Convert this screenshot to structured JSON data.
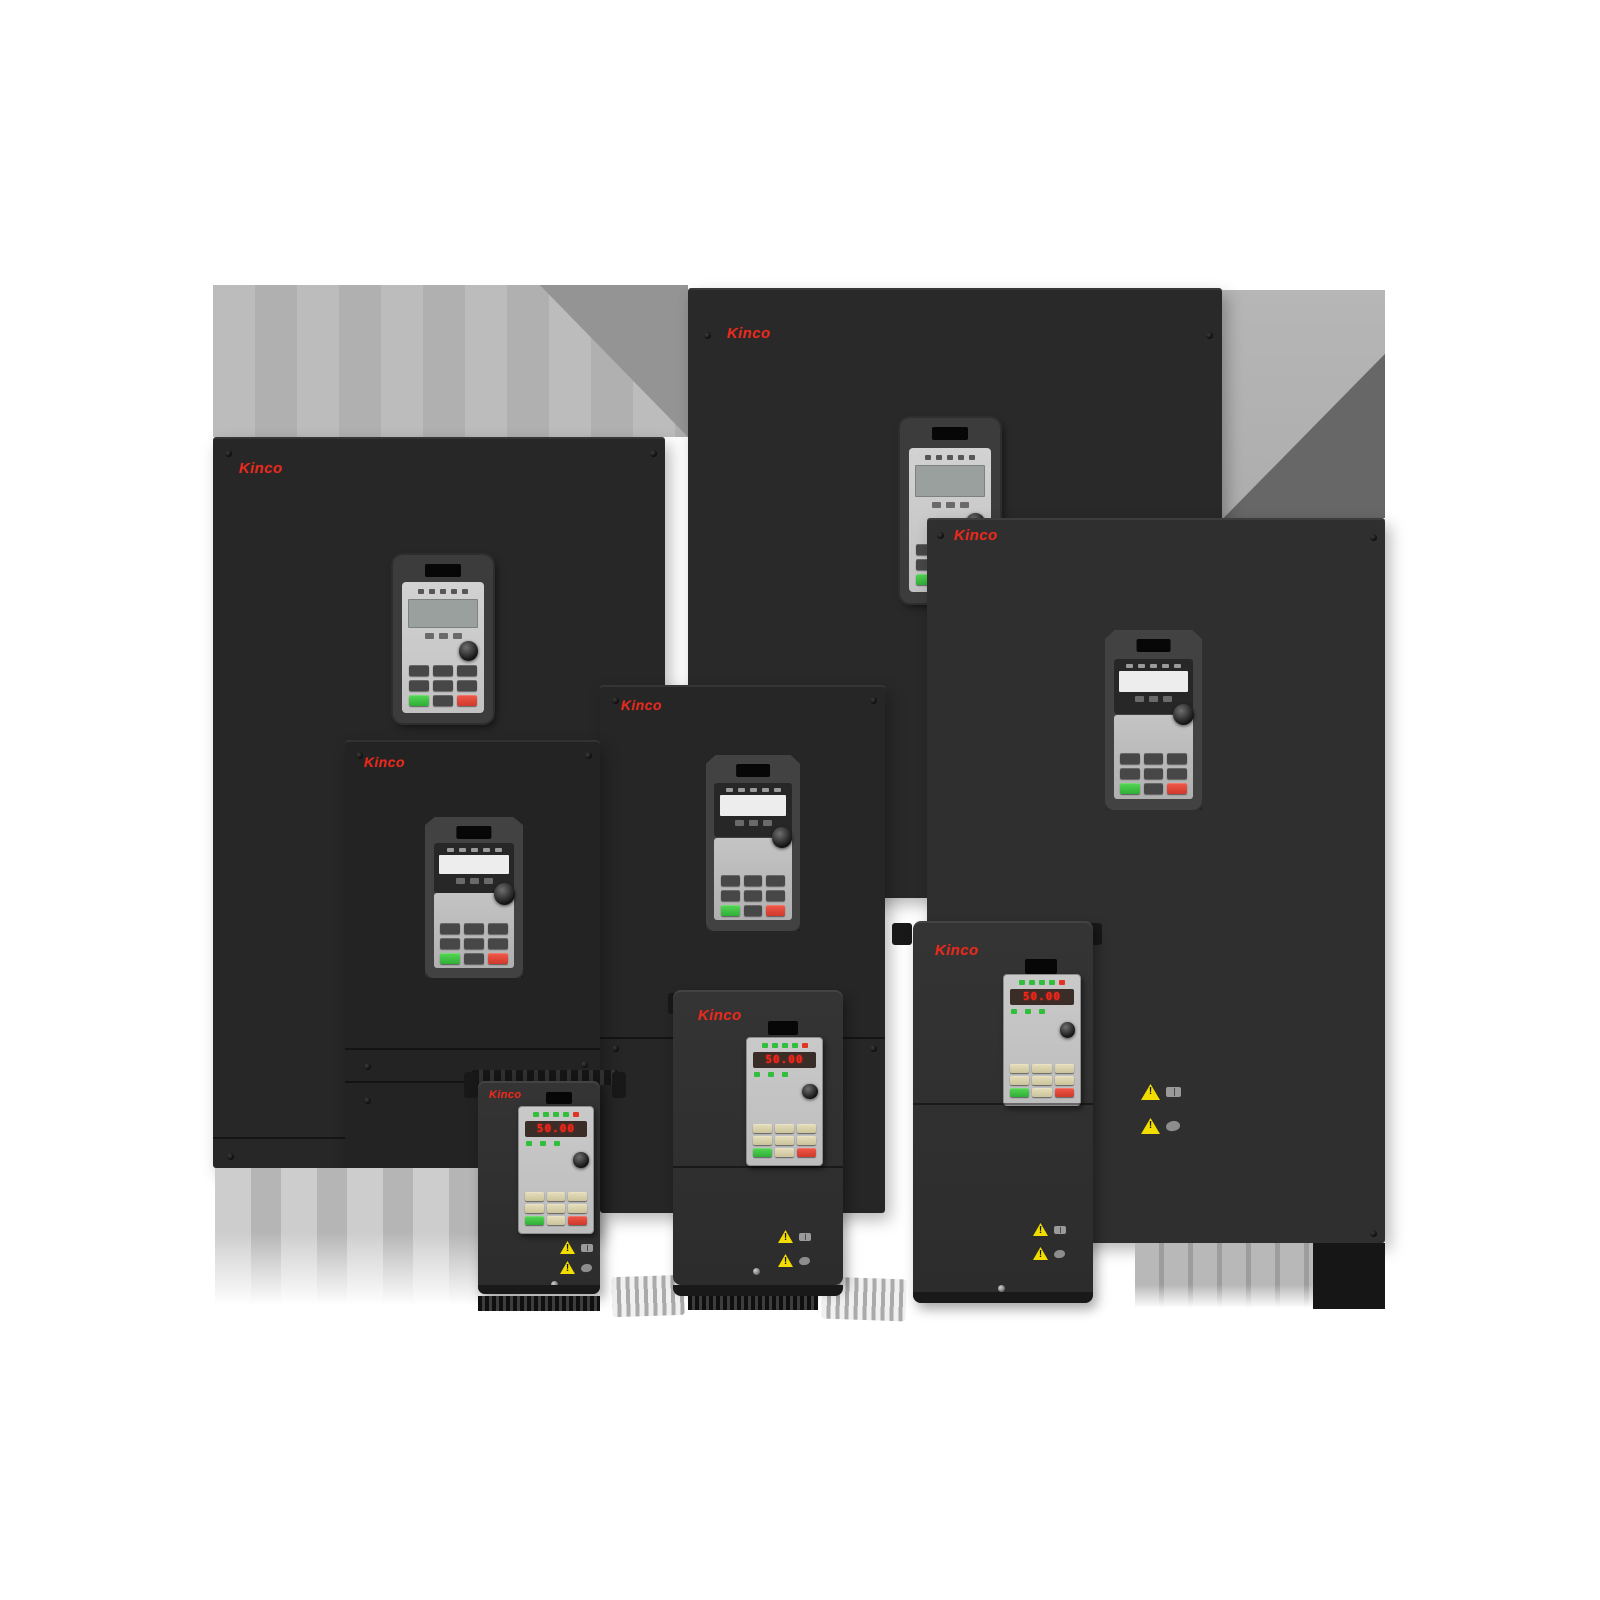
{
  "image_type": "product-photo",
  "subject": "Kinco variable frequency drive (inverter) product family, eight units grouped",
  "brand": "Kinco",
  "colors": {
    "background": "#ffffff",
    "panel_dark": "#2a2a2a",
    "backdrop_gray": "#b4b4b4",
    "backdrop_shadow": "#6b6b6b",
    "brand_red": "#e62b1e",
    "display_red": "#ff2318",
    "led_green": "#2fbf3a",
    "led_red": "#e03424",
    "run_button_green": "#3fca44",
    "stop_button_red": "#e04838",
    "warning_yellow": "#f2dd00",
    "keypad_face_gray": "#c6c6c6"
  },
  "units": [
    {
      "name": "large-drive-back-left",
      "brand": "Kinco"
    },
    {
      "name": "large-drive-top-right",
      "brand": "Kinco"
    },
    {
      "name": "large-drive-right",
      "brand": "Kinco",
      "warnings": [
        "general-warning",
        "read-manual",
        "electric-hazard"
      ]
    },
    {
      "name": "large-drive-middle",
      "brand": "Kinco"
    },
    {
      "name": "large-drive-left-middle",
      "brand": "Kinco"
    },
    {
      "name": "compact-drive-small",
      "brand": "Kinco",
      "display": "50.00",
      "warnings": [
        "general-warning",
        "read-manual",
        "electric-hazard"
      ]
    },
    {
      "name": "compact-drive-medium",
      "brand": "Kinco",
      "display": "50.00",
      "warnings": [
        "general-warning",
        "read-manual",
        "electric-hazard"
      ]
    },
    {
      "name": "compact-drive-large",
      "brand": "Kinco",
      "display": "50.00",
      "warnings": [
        "general-warning",
        "read-manual",
        "electric-hazard"
      ]
    }
  ],
  "icons": {
    "warning_triangle": "yellow triangle with exclamation mark",
    "read_manual": "open book pictogram",
    "electric_hazard": "hand / shock pictogram",
    "screw": "round panel screw",
    "knob": "round potentiometer knob",
    "card_slot": "dark keypad slot",
    "heatsink_fins": "vertical cooling fins"
  }
}
